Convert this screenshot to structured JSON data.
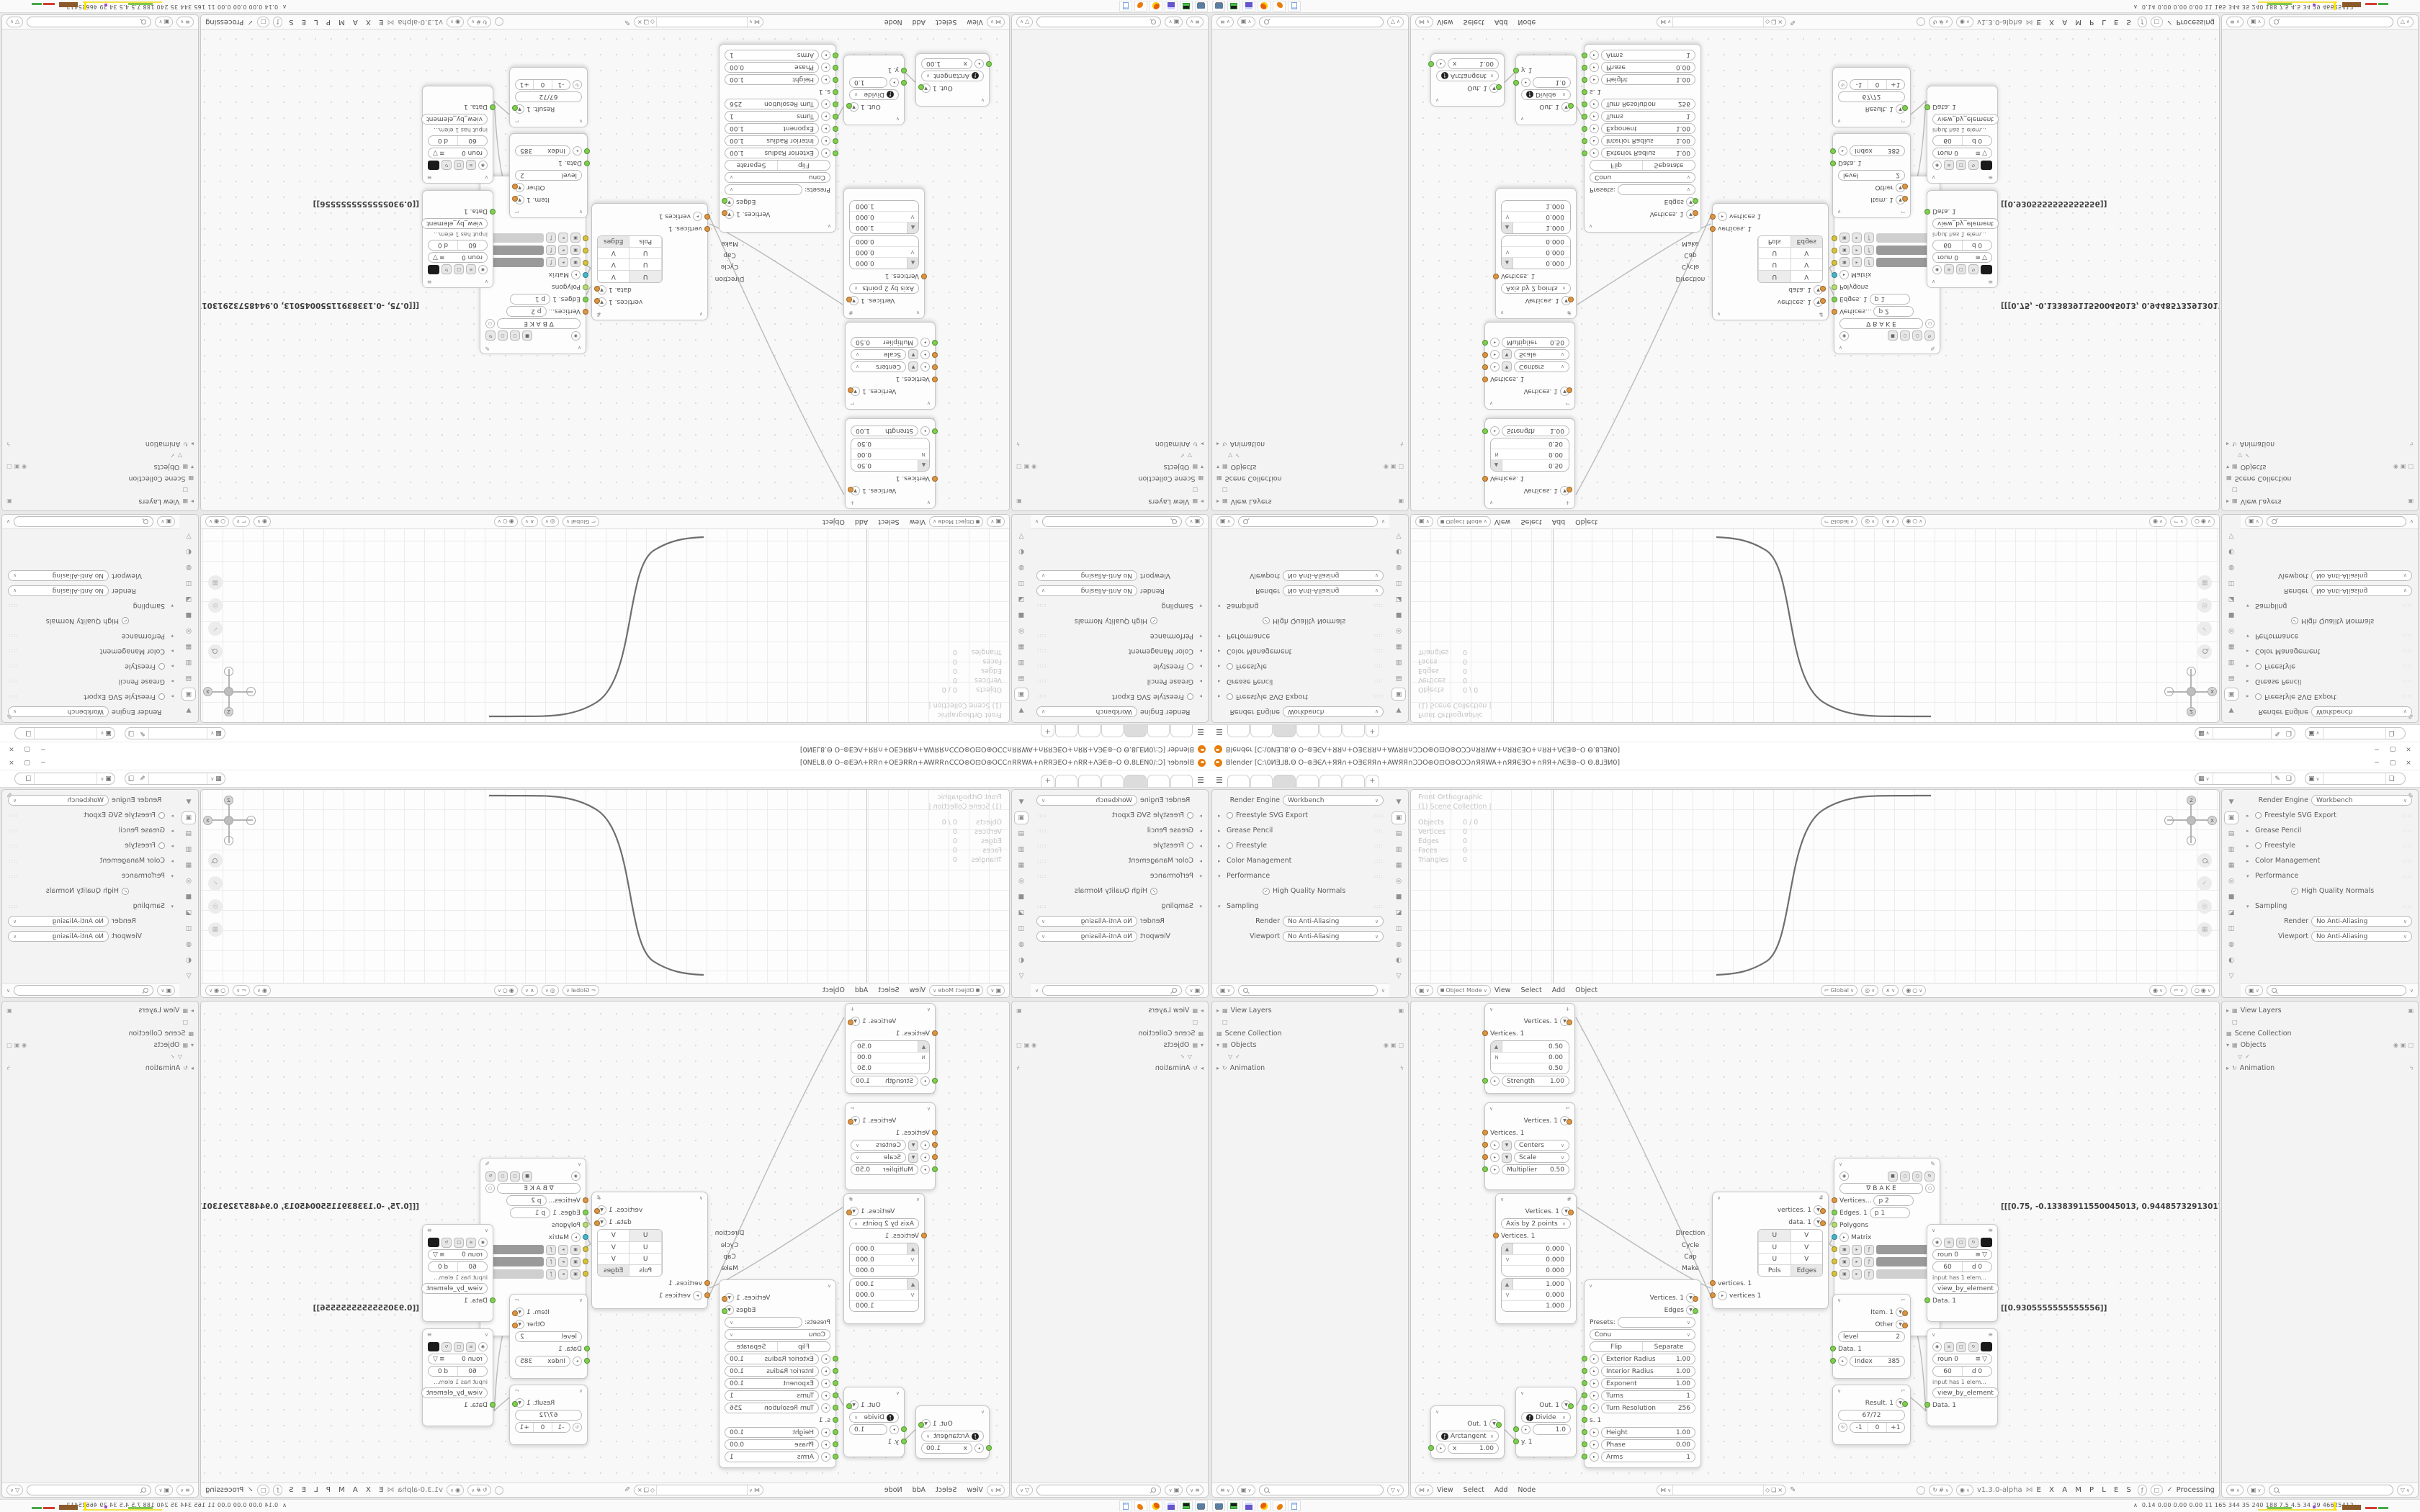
{
  "g": {
    "cv": "∨",
    "up": "∧",
    "tri": "▼",
    "tris": "▸",
    "trid": "▾",
    "plus": "+",
    "burger": "☰",
    "pin": "✎",
    "chk": "✓",
    "fil": "▽",
    "eq": "≡",
    "fx": "ƒ",
    "dna": "⋈",
    "ref": "↻",
    "dot": "•",
    "sq": "■",
    "cir": "○",
    "dcir": "◉",
    "nab": "∇",
    "corner": "⌐",
    "hash": "#",
    "box": "▦",
    "boxs": "▣",
    "sqo": "□",
    "bolt": "ϟ",
    "shield": "◇",
    "copy": "❏",
    "close": "×",
    "grid": "#",
    "cam": "◎",
    "z": "Z",
    "x": "X",
    "y": "Y"
  },
  "title": {
    "text": "Blender [C:\\0ИƎ⅃8.Θ O–⊚ƎЄΛ+ЯЯ∩+OƎЄЯЯ∩+AWЯЯ∩ƆƆO⊛O⊡O⊛OƆƆ∩ЯЯWA+∩ЯЯЄƎO+∩ЯЯ+ΛЄƎ⊚–O Θ.8⅃ƎИ0]",
    "min": "─",
    "max": "▢",
    "close": "×"
  },
  "props": {
    "rel": "Render Engine",
    "rev": "Workbench",
    "r1": "Freestyle SVG Export",
    "r2": "Grease Pencil",
    "r3": "Freestyle",
    "r4": "Color Management",
    "r5": "Performance",
    "hqn": "High Quality Normals",
    "r6": "Sampling",
    "srl": "Render",
    "srv": "No Anti-Aliasing",
    "svl": "Viewport",
    "svv": "No Anti-Aliasing",
    "tabs": [
      "▼",
      "▣",
      "▤",
      "▥",
      "▦",
      "◎",
      "■",
      "◪",
      "◫",
      "◍",
      "◐",
      "▽"
    ]
  },
  "vp": {
    "l1": "Front Orthographic",
    "l2": "(1) Scene Collection |",
    "s": [
      [
        "Objects",
        "0 / 0"
      ],
      [
        "Vertices",
        "0"
      ],
      [
        "Edges",
        "0"
      ],
      [
        "Faces",
        "0"
      ],
      [
        "Triangles",
        "0"
      ]
    ],
    "mode": "Object Mode",
    "m": [
      "View",
      "Select",
      "Add",
      "Object"
    ],
    "orient": "Global"
  },
  "o": {
    "i1": "View Layers",
    "i2": "Scene Collection",
    "i3": "Objects",
    "i4": "Animation"
  },
  "nh": {
    "m": [
      "View",
      "Select",
      "Add",
      "Node"
    ],
    "ver": "v1.3.0-alpha",
    "ex": "E X A M P L E S",
    "proc": "Processing"
  },
  "nodes": {
    "noise": {
      "out": "Vertices. 1",
      "in": "Vertices. 1",
      "v1l": "▲",
      "v1": "0.50",
      "v2l": "N",
      "v2": "0.00",
      "v3": "0.50",
      "f1l": "Strength",
      "f1": "1.00"
    },
    "move": {
      "out": "Vertices. 1",
      "in": "Vertices. 1",
      "d1": "Centers",
      "d2": "Scale",
      "f1l": "Multiplier",
      "f1": "0.50"
    },
    "axis": {
      "out": "Vertices. 1",
      "mode": "Axis by 2 points",
      "in": "Vertices. 1",
      "v1l": "▲",
      "v2l": "V",
      "a1": "0.000",
      "a2": "0.000",
      "a3": "0.000",
      "b1": "1.000",
      "b2": "0.000",
      "b3": "1.000"
    },
    "arct": {
      "out": "Out. 1",
      "fn": "Arctangent",
      "xl": "x",
      "xv": "1.00"
    },
    "div": {
      "out": "Out. 1",
      "fn": "Divide",
      "v": "1.0",
      "y": "y. 1"
    },
    "conu": {
      "out1": "Vertices. 1",
      "out2": "Edges",
      "presets": "Presets:",
      "mode": "Conu",
      "b1": "Flip",
      "b2": "Separate",
      "f": [
        [
          "Exterior Radius",
          "1.00"
        ],
        [
          "Interior Radius",
          "1.00"
        ],
        [
          "Exponent",
          "1.00"
        ],
        [
          "Turns",
          "1"
        ],
        [
          "Turn Resolution",
          "256"
        ]
      ],
      "s": "s. 1",
      "f2": [
        [
          "Height",
          "1.00"
        ],
        [
          "Phase",
          "0.00"
        ],
        [
          "Arms",
          "1"
        ]
      ]
    },
    "uv": {
      "out1": "vertices. 1",
      "out2": "data. 1",
      "rows": [
        [
          "Direction",
          "U",
          "V"
        ],
        [
          "Cycle",
          "U",
          "V"
        ],
        [
          "Cap",
          "U",
          "V"
        ],
        [
          "Make",
          "Pols",
          "Edges"
        ]
      ],
      "in1": "vertices. 1",
      "in2": "vertices 1"
    },
    "bake": {
      "label": "B A K E",
      "s1": "Vertices...",
      "p1": "p  2",
      "s2": "Edges. 1",
      "p2": "p  1",
      "s3": "Polygons",
      "s4": "Matrix"
    },
    "viewer": {
      "r1": "roun  0",
      "r2a": "60",
      "r2b": "d  0",
      "info": "input has 1 elem...",
      "btn": "view_by_element",
      "data": "Data. 1"
    },
    "item": {
      "in1": "Item. 1",
      "in2": "Other",
      "lvl": "level",
      "lvlv": "2",
      "data": "Data. 1",
      "idx": "Index",
      "idxv": "385"
    },
    "res": {
      "out": "Result. 1",
      "frac": "67/72",
      "m": "-1",
      "z": "0",
      "p": "+1"
    },
    "prints": {
      "p1": "[[[0.75, -0.13383911550045013, 0.9448573291301727]]]",
      "p2": "[[0.9305555555555556]]"
    }
  },
  "tb": {
    "stats": "0.14 0.00 0.00 0.00    11    165  344    35    240  188    7.5    4.5    34    29   46625412"
  }
}
